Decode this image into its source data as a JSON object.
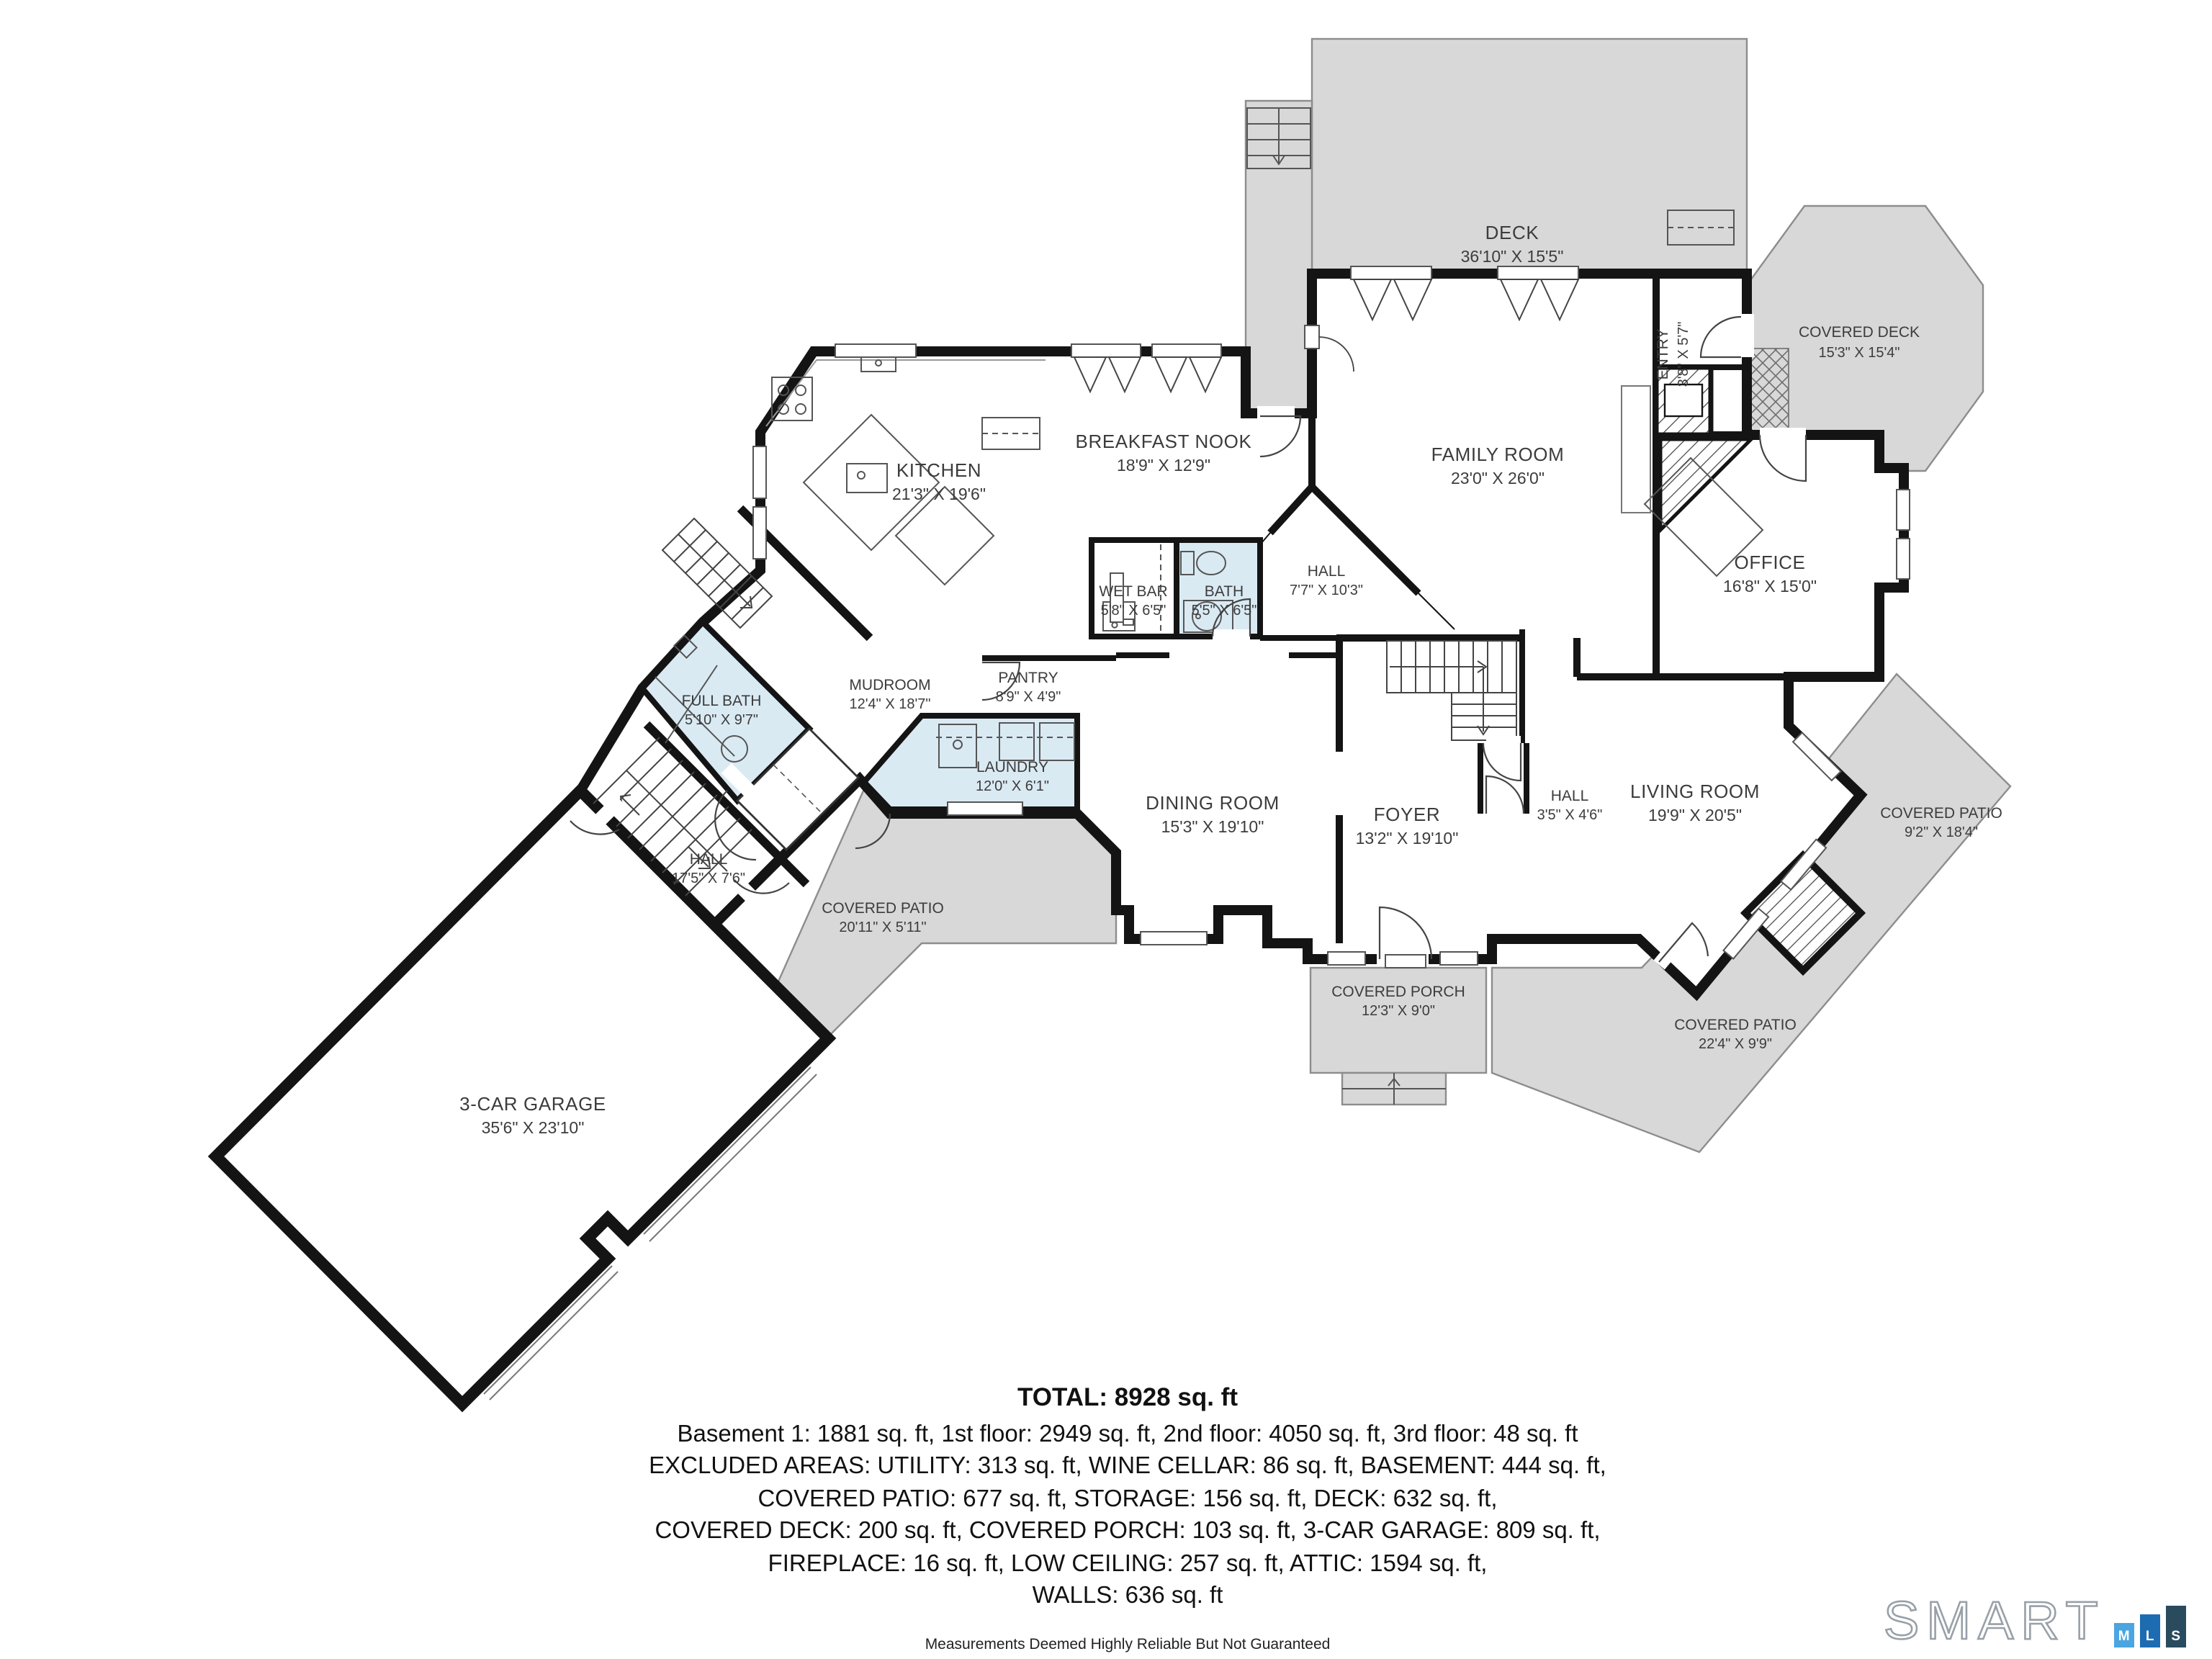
{
  "rooms": {
    "deck": {
      "name": "DECK",
      "dims": "36'10\" X 15'5\""
    },
    "covered_deck": {
      "name": "COVERED DECK",
      "dims": "15'3\" X 15'4\""
    },
    "entry": {
      "name": "ENTRY",
      "dims": "3'8\" X 5'7\""
    },
    "family": {
      "name": "FAMILY ROOM",
      "dims": "23'0\" X 26'0\""
    },
    "breakfast": {
      "name": "BREAKFAST NOOK",
      "dims": "18'9\" X 12'9\""
    },
    "kitchen": {
      "name": "KITCHEN",
      "dims": "21'3\" X 19'6\""
    },
    "wet_bar": {
      "name": "WET BAR",
      "dims": "5'8\" X 6'5\""
    },
    "bath": {
      "name": "BATH",
      "dims": "5'5\" X 6'5\""
    },
    "hall_main": {
      "name": "HALL",
      "dims": "7'7\" X 10'3\""
    },
    "office": {
      "name": "OFFICE",
      "dims": "16'8\" X 15'0\""
    },
    "pantry": {
      "name": "PANTRY",
      "dims": "8'9\" X 4'9\""
    },
    "mudroom": {
      "name": "MUDROOM",
      "dims": "12'4\" X 18'7\""
    },
    "full_bath": {
      "name": "FULL BATH",
      "dims": "5'10\" X 9'7\""
    },
    "laundry": {
      "name": "LAUNDRY",
      "dims": "12'0\" X 6'1\""
    },
    "dining": {
      "name": "DINING ROOM",
      "dims": "15'3\" X 19'10\""
    },
    "foyer": {
      "name": "FOYER",
      "dims": "13'2\" X 19'10\""
    },
    "hall_small": {
      "name": "HALL",
      "dims": "3'5\" X 4'6\""
    },
    "living": {
      "name": "LIVING ROOM",
      "dims": "19'9\" X 20'5\""
    },
    "hall_garage": {
      "name": "HALL",
      "dims": "17'5\" X 7'6\""
    },
    "garage": {
      "name": "3-CAR GARAGE",
      "dims": "35'6\" X 23'10\""
    },
    "patio_right": {
      "name": "COVERED PATIO",
      "dims": "9'2\" X 18'4\""
    },
    "patio_bottom": {
      "name": "COVERED PATIO",
      "dims": "22'4\" X 9'9\""
    },
    "porch": {
      "name": "COVERED PORCH",
      "dims": "12'3\" X 9'0\""
    },
    "patio_left": {
      "name": "COVERED PATIO",
      "dims": "20'11\" X 5'11\""
    }
  },
  "summary": {
    "total": "TOTAL: 8928 sq. ft",
    "line1": "Basement 1: 1881 sq. ft, 1st floor: 2949 sq. ft, 2nd floor: 4050 sq. ft, 3rd floor: 48 sq. ft",
    "line2": "EXCLUDED AREAS: UTILITY: 313 sq. ft, WINE CELLAR: 86 sq. ft, BASEMENT: 444 sq. ft,",
    "line3": "COVERED PATIO: 677 sq. ft, STORAGE: 156 sq. ft, DECK: 632 sq. ft,",
    "line4": "COVERED DECK: 200 sq. ft, COVERED PORCH: 103 sq. ft, 3-CAR GARAGE: 809 sq. ft,",
    "line5": "FIREPLACE: 16 sq. ft, LOW CEILING: 257 sq. ft, ATTIC: 1594 sq. ft,",
    "line6": "WALLS: 636 sq. ft"
  },
  "disclaimer": "Measurements Deemed Highly Reliable But Not Guaranteed",
  "logo": {
    "brand": "SMART",
    "m": "M",
    "l": "L",
    "s": "S"
  },
  "colors": {
    "wall": "#141414",
    "outdoor_fill": "#d8d8d8",
    "wet_room_fill": "#daeaf3",
    "logo_m": "#4ba5e0",
    "logo_l": "#1d6cb1",
    "logo_s": "#2a4b5e"
  }
}
